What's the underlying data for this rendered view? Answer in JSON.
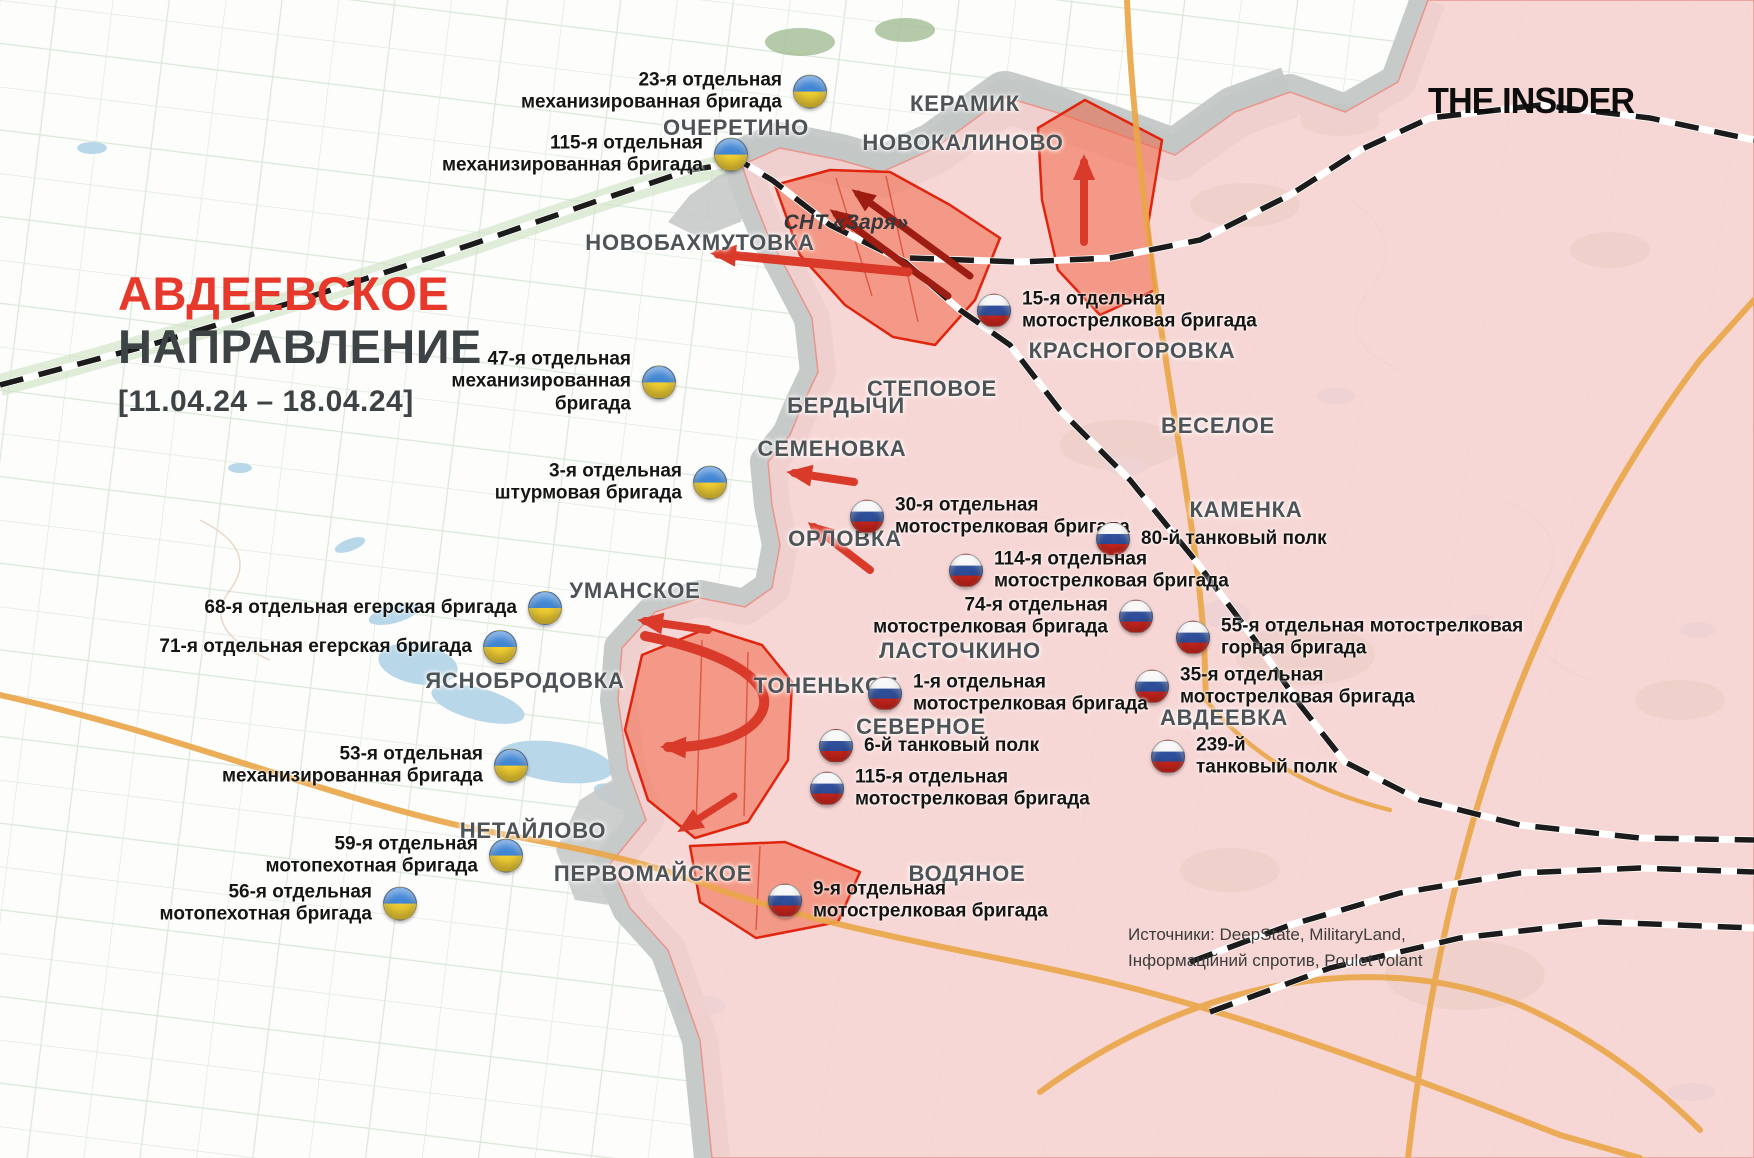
{
  "meta": {
    "brand": "THE INSIDER",
    "sources": "Источники: DeepState, MilitaryLand,\nІнформаційний спротив, Poulet volant"
  },
  "title": {
    "line1": "АВДЕЕВСКОЕ",
    "line2": "НАПРАВЛЕНИЕ",
    "period": "[11.04.24 – 18.04.24]"
  },
  "colors": {
    "accent_red": "#e6392c",
    "occupied_pink": "#f6d2cf",
    "contested_gray": "#c3c7c6",
    "advance_zone_fill": "#f2603f",
    "advance_zone_border": "#e0250f",
    "arrow_red": "#d93a29",
    "ua_flag_blue": "#4186d4",
    "ua_flag_yellow": "#f2cf33",
    "ru_flag_blue": "#2f4f9b",
    "ru_flag_red": "#d2271d"
  },
  "towns": [
    {
      "name": "КЕРАМИК"
    },
    {
      "name": "НОВОКАЛИНОВО"
    },
    {
      "name": "ОЧЕРЕТИНО"
    },
    {
      "name": "НОВОБАХМУТОВКА"
    },
    {
      "name": "СНТ «Заря»"
    },
    {
      "name": "КРАСНОГОРОВКА"
    },
    {
      "name": "СТЕПОВОЕ"
    },
    {
      "name": "БЕРДЫЧИ"
    },
    {
      "name": "ВЕСЕЛОЕ"
    },
    {
      "name": "СЕМЕНОВКА"
    },
    {
      "name": "КАМЕНКА"
    },
    {
      "name": "ОРЛОВКА"
    },
    {
      "name": "УМАНСКОЕ"
    },
    {
      "name": "ЛАСТОЧКИНО"
    },
    {
      "name": "ЯСНОБРОДОВКА"
    },
    {
      "name": "ТОНЕНЬКОЕ"
    },
    {
      "name": "СЕВЕРНОЕ"
    },
    {
      "name": "АВДЕЕВКА"
    },
    {
      "name": "НЕТАЙЛОВО"
    },
    {
      "name": "ПЕРВОМАЙСКОЕ"
    },
    {
      "name": "ВОДЯНОЕ"
    }
  ],
  "units": [
    {
      "side": "ua",
      "name": "23-я отдельная\nмеханизированная бригада"
    },
    {
      "side": "ua",
      "name": "115-я отдельная\nмеханизированная бригада"
    },
    {
      "side": "ua",
      "name": "47-я отдельная\nмеханизированная\nбригада"
    },
    {
      "side": "ua",
      "name": "3-я отдельная\nштурмовая бригада"
    },
    {
      "side": "ua",
      "name": "68-я отдельная егерская бригада"
    },
    {
      "side": "ua",
      "name": "71-я отдельная егерская бригада"
    },
    {
      "side": "ua",
      "name": "53-я отдельная\nмеханизированная бригада"
    },
    {
      "side": "ua",
      "name": "59-я отдельная\nмотопехотная бригада"
    },
    {
      "side": "ua",
      "name": "56-я отдельная\nмотопехотная бригада"
    },
    {
      "side": "ru",
      "name": "15-я отдельная\nмотострелковая бригада"
    },
    {
      "side": "ru",
      "name": "30-я отдельная\nмотострелковая бригада"
    },
    {
      "side": "ru",
      "name": "80-й танковый полк"
    },
    {
      "side": "ru",
      "name": "114-я отдельная\nмотострелковая бригада"
    },
    {
      "side": "ru",
      "name": "74-я отдельная\nмотострелковая бригада"
    },
    {
      "side": "ru",
      "name": "55-я отдельная мотострелковая\nгорная бригада"
    },
    {
      "side": "ru",
      "name": "35-я отдельная\nмотострелковая бригада"
    },
    {
      "side": "ru",
      "name": "1-я отдельная\nмотострелковая бригада"
    },
    {
      "side": "ru",
      "name": "6-й танковый полк"
    },
    {
      "side": "ru",
      "name": "115-я отдельная\nмотострелковая бригада"
    },
    {
      "side": "ru",
      "name": "239-й\nтанковый полк"
    },
    {
      "side": "ru",
      "name": "9-я отдельная\nмотострелковая бригада"
    }
  ]
}
